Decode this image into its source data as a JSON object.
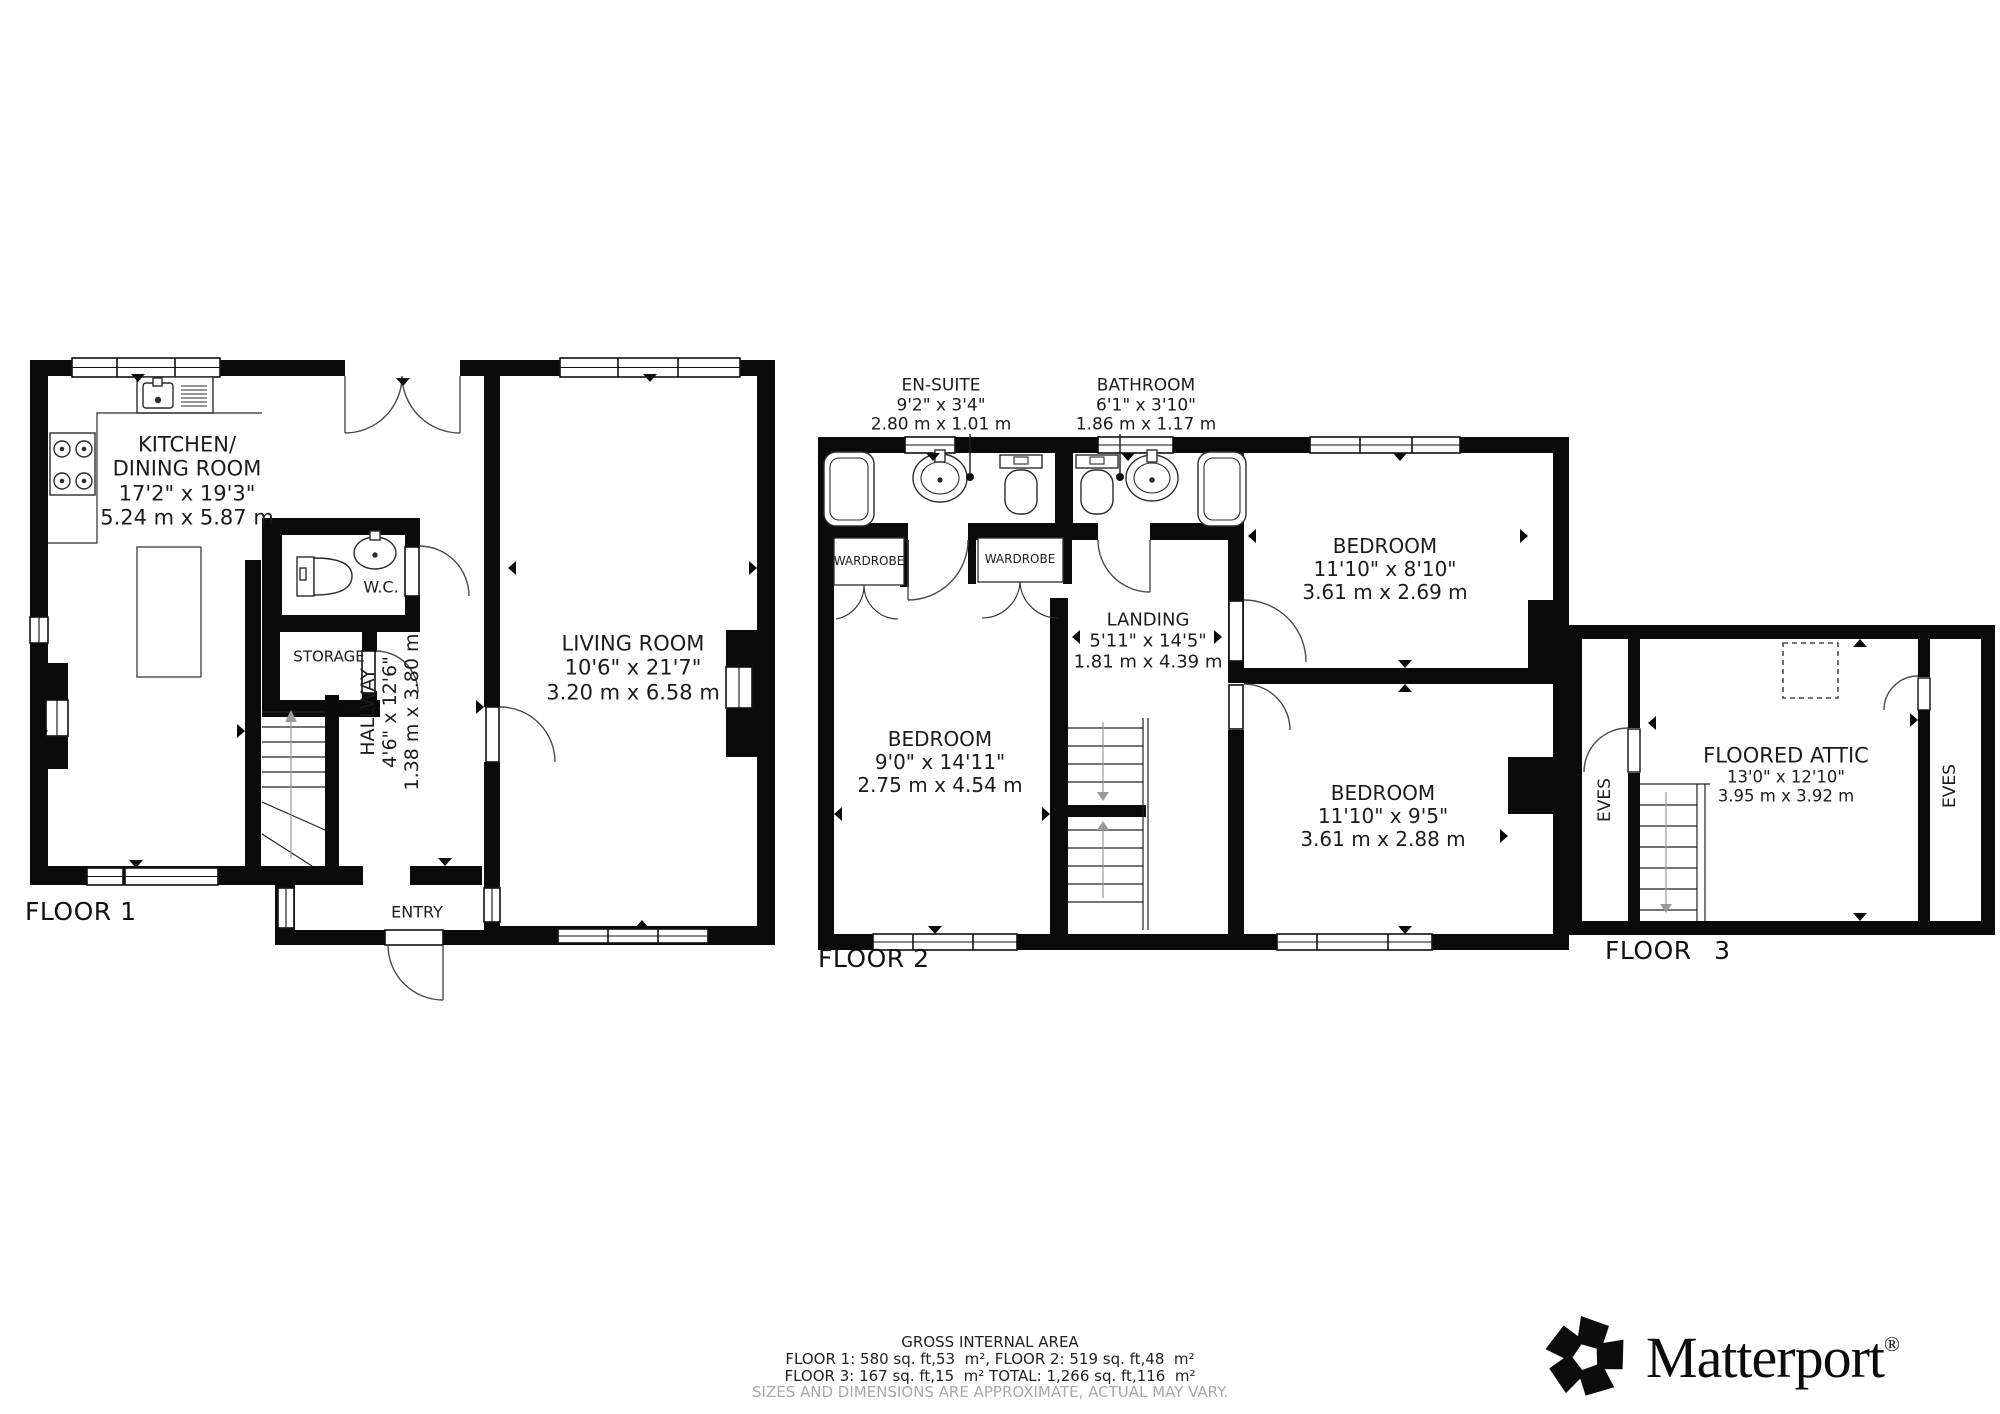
{
  "floor1": {
    "label": "FLOOR 1",
    "kitchen": {
      "name_line1": "KITCHEN/",
      "name_line2": "DINING ROOM",
      "imperial": "17'2\" x 19'3\"",
      "metric": "5.24 m x 5.87 m"
    },
    "wc": {
      "name": "W.C."
    },
    "storage": {
      "name": "STORAGE"
    },
    "hallway": {
      "name": "HALLWAY",
      "imperial": "4'6\" x 12'6\"",
      "metric": "1.38 m x 3.80 m"
    },
    "living_room": {
      "name": "LIVING ROOM",
      "imperial": "10'6\" x 21'7\"",
      "metric": "3.20 m x 6.58 m"
    },
    "entry": {
      "name": "ENTRY"
    }
  },
  "floor2": {
    "label": "FLOOR 2",
    "ensuite": {
      "name": "EN-SUITE",
      "imperial": "9'2\" x 3'4\"",
      "metric": "2.80 m x 1.01 m"
    },
    "bathroom": {
      "name": "BATHROOM",
      "imperial": "6'1\" x 3'10\"",
      "metric": "1.86 m x 1.17 m"
    },
    "wardrobe_left": {
      "name": "WARDROBE"
    },
    "wardrobe_right": {
      "name": "WARDROBE"
    },
    "landing": {
      "name": "LANDING",
      "imperial": "5'11\" x 14'5\"",
      "metric": "1.81 m x 4.39 m"
    },
    "bedroom_top": {
      "name": "BEDROOM",
      "imperial": "11'10\" x 8'10\"",
      "metric": "3.61 m x 2.69 m"
    },
    "bedroom_left": {
      "name": "BEDROOM",
      "imperial": "9'0\" x 14'11\"",
      "metric": "2.75 m x 4.54 m"
    },
    "bedroom_bottom": {
      "name": "BEDROOM",
      "imperial": "11'10\" x 9'5\"",
      "metric": "3.61 m x 2.88 m"
    }
  },
  "floor3": {
    "label": "FLOOR 3",
    "attic": {
      "name": "FLOORED ATTIC",
      "imperial": "13'0\" x 12'10\"",
      "metric": "3.95 m x 3.92 m"
    },
    "eves_left": "EVES",
    "eves_right": "EVES"
  },
  "footer": {
    "title": "GROSS INTERNAL AREA",
    "line1": "FLOOR 1: 580 sq. ft,53  m², FLOOR 2: 519 sq. ft,48  m²",
    "line2": "FLOOR 3: 167 sq. ft,15  m² TOTAL: 1,266 sq. ft,116  m²",
    "disclaimer": "SIZES AND DIMENSIONS ARE APPROXIMATE, ACTUAL MAY VARY.",
    "disclaimer_color": "#a9a9a9"
  },
  "brand": {
    "wordmark": "Matterport",
    "registered": "®"
  },
  "colors": {
    "wall": "#0a0a0a",
    "background": "#ffffff",
    "text": "#1c1c1c"
  }
}
